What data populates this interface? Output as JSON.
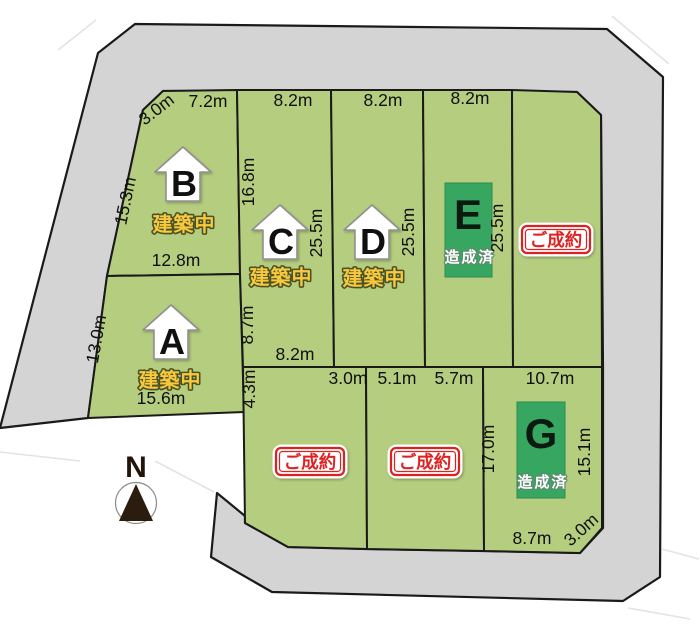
{
  "map_title": "宅地分譲区画図",
  "compass": {
    "north": "N"
  },
  "colors": {
    "road_gray": "#d4d4d4",
    "plot_green": "#b5cd7f",
    "developed_green": "#36a660",
    "sold_red": "#dd2222",
    "construction_yellow": "#f8c93c",
    "outline_black": "#1a1a1a"
  },
  "plots": {
    "a": {
      "letter": "A",
      "status": "建築中"
    },
    "b": {
      "letter": "B",
      "status": "建築中"
    },
    "c": {
      "letter": "C",
      "status": "建築中"
    },
    "d": {
      "letter": "D",
      "status": "建築中"
    },
    "e": {
      "letter": "E",
      "status": "造成済"
    },
    "f": {
      "status": "ご成約"
    },
    "g": {
      "letter": "G",
      "status": "造成済"
    },
    "h": {
      "status": "ご成約"
    },
    "i": {
      "status": "ご成約"
    }
  },
  "dims": {
    "b_diag": "3.0m",
    "b_top": "7.2m",
    "b_left": "15.3m",
    "b_bottom": "12.8m",
    "c_top": "8.2m",
    "c_left_upper": "16.8m",
    "c_left_lower": "8.7m",
    "c_right": "25.5m",
    "c_bottom": "8.2m",
    "d_top": "8.2m",
    "d_right": "25.5m",
    "e_top": "8.2m",
    "e_right": "25.5m",
    "a_left": "13.0m",
    "a_bottom": "15.6m",
    "h_left": "4.3m",
    "h_top_right": "3.0m",
    "i_top_left": "5.1m",
    "i_top_right": "5.7m",
    "g_top": "10.7m",
    "g_left": "17.0m",
    "g_right": "15.1m",
    "g_bottom": "8.7m",
    "g_diag": "3.0m"
  }
}
